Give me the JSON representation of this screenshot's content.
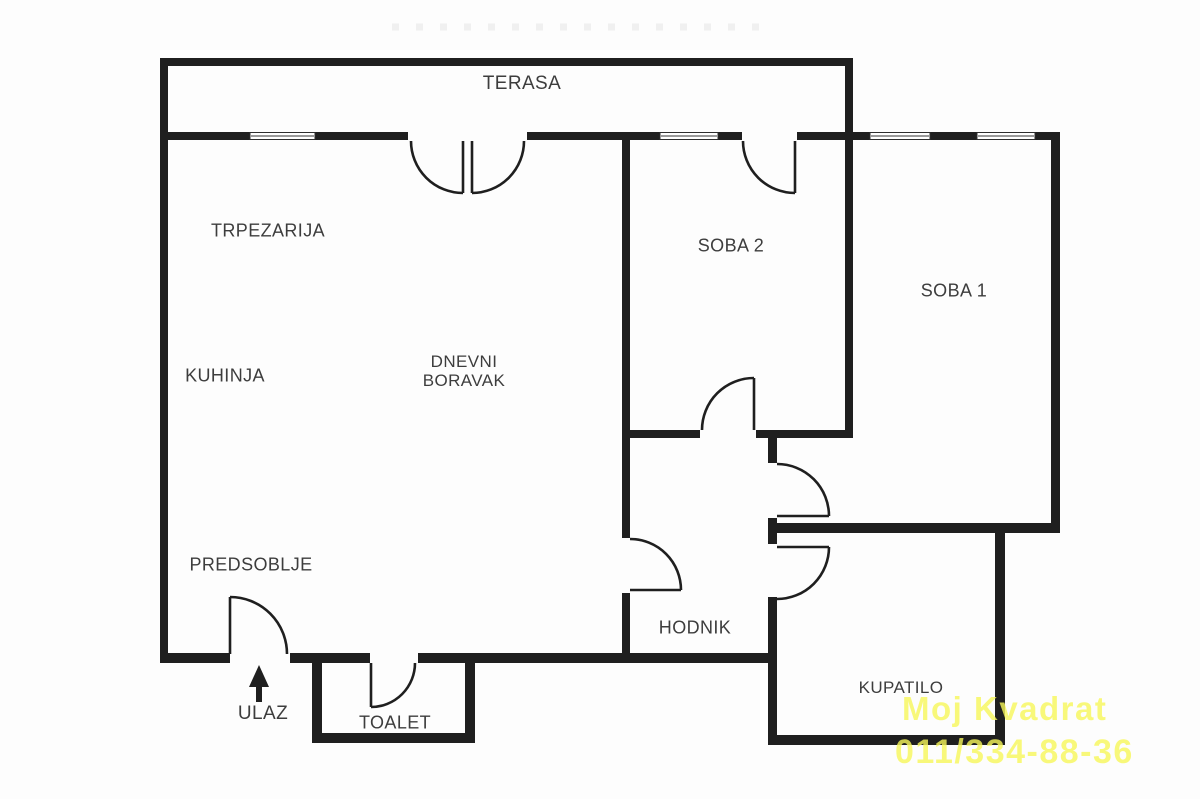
{
  "floorplan": {
    "colors": {
      "wall": "#1f1f1f",
      "label": "#3d3d3d",
      "watermark": "#f8f85a",
      "window": "#9a9a9a"
    },
    "rooms": {
      "terasa": {
        "label": "TERASA"
      },
      "trpezarija": {
        "label": "TRPEZARIJA"
      },
      "kuhinja": {
        "label": "KUHINJA"
      },
      "dnevni_boravak": {
        "line1": "DNEVNI",
        "line2": "BORAVAK"
      },
      "soba2": {
        "label": "SOBA 2"
      },
      "soba1": {
        "label": "SOBA 1"
      },
      "predsoblje": {
        "label": "PREDSOBLJE"
      },
      "hodnik": {
        "label": "HODNIK"
      },
      "kupatilo": {
        "label": "KUPATILO"
      },
      "toalet": {
        "label": "TOALET"
      }
    },
    "entrance": {
      "label": "ULAZ"
    }
  },
  "watermark": {
    "line1": "Moj Kvadrat",
    "line2": "011/334-88-36"
  }
}
